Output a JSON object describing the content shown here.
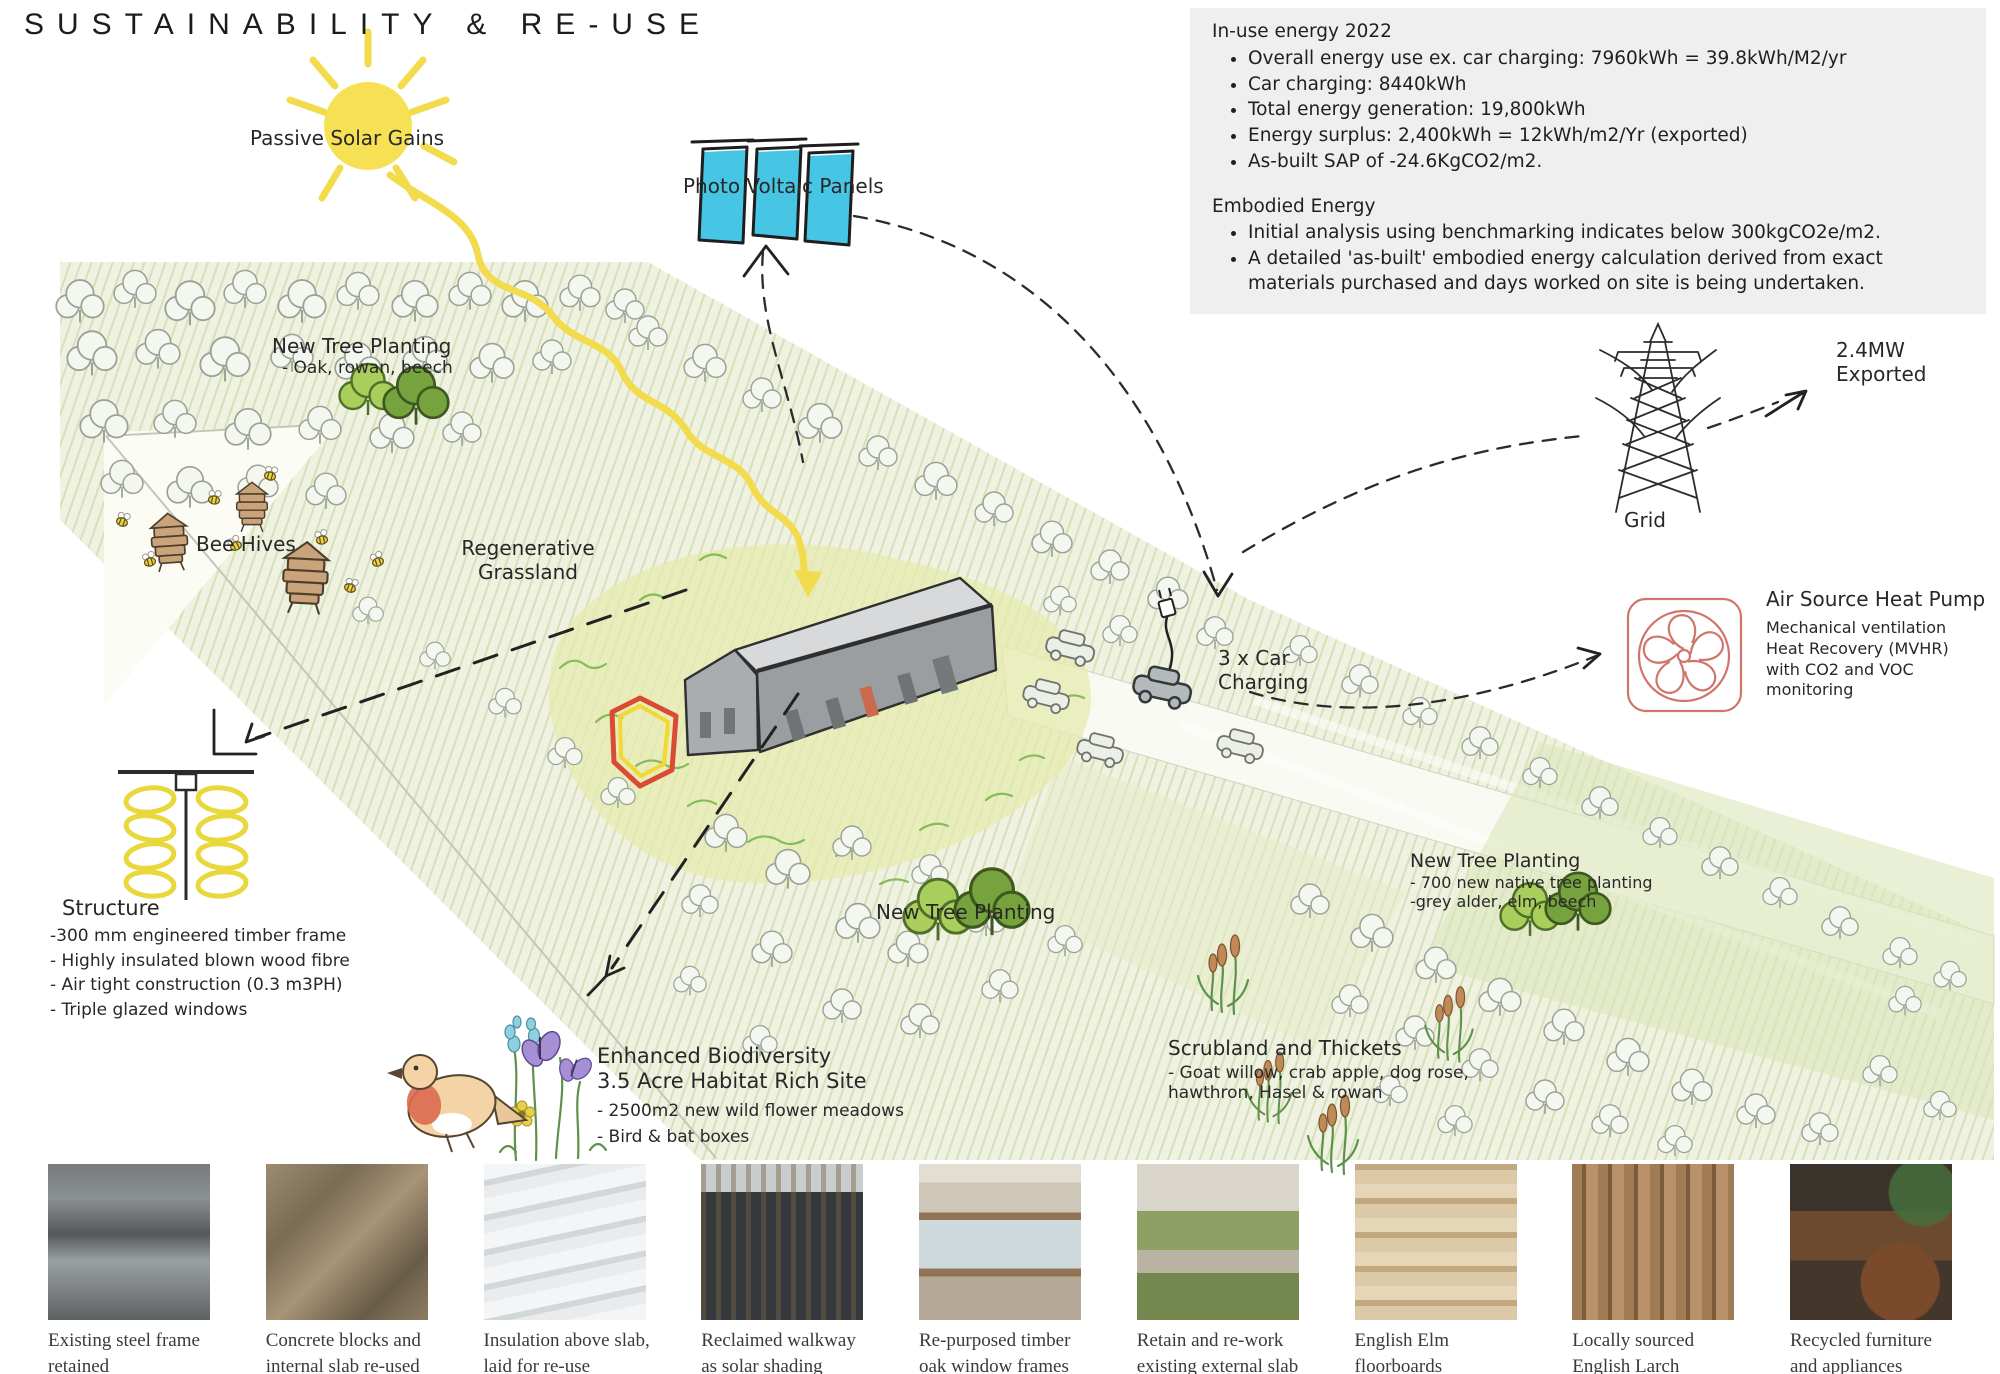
{
  "title": "SUSTAINABILITY & RE-USE",
  "energy_box": {
    "in_use": {
      "heading": "In-use energy 2022",
      "bullets": [
        "Overall energy use ex. car charging: 7960kWh = 39.8kWh/M2/yr",
        "Car charging: 8440kWh",
        "Total energy generation: 19,800kWh",
        "Energy surplus: 2,400kWh = 12kWh/m2/Yr (exported)",
        "As-built SAP of -24.6KgCO2/m2."
      ]
    },
    "embodied": {
      "heading": "Embodied Energy",
      "bullets": [
        "Initial analysis using benchmarking indicates below 300kgCO2e/m2.",
        "A detailed 'as-built' embodied energy calculation derived from exact materials purchased and days worked on site is being undertaken."
      ]
    }
  },
  "diagram": {
    "passive_solar": "Passive Solar Gains",
    "pv_panels": "Photo Voltaic Panels",
    "tree_planting_nw": {
      "title": "New Tree Planting",
      "sub": "- Oak, rowan, beech"
    },
    "bee_hives": "Bee Hives",
    "grassland": {
      "line1": "Regenerative",
      "line2": "Grassland"
    },
    "car_charging": {
      "line1": "3 x Car",
      "line2": "Charging"
    },
    "grid": "Grid",
    "exported": {
      "line1": "2.4MW",
      "line2": "Exported"
    },
    "ashp": {
      "title": "Air Source Heat Pump",
      "desc": "Mechanical ventilation Heat Recovery (MVHR) with CO2 and VOC monitoring"
    },
    "structure": {
      "title": "Structure",
      "lines": [
        "-300 mm engineered timber frame",
        "- Highly insulated blown wood fibre",
        "- Air tight construction (0.3 m3PH)",
        "- Triple glazed windows"
      ]
    },
    "biodiversity": {
      "line1": "Enhanced Biodiversity",
      "line2": "3.5 Acre Habitat Rich Site",
      "bullets": [
        "- 2500m2 new wild flower meadows",
        "- Bird & bat boxes"
      ]
    },
    "tree_planting_mid": "New Tree Planting",
    "scrubland": {
      "title": "Scrubland and Thickets",
      "line2": "- Goat willow, crab apple, dog rose,",
      "line3": "hawthron, Hasel & rowan"
    },
    "tree_planting_east": {
      "title": "New Tree Planting",
      "line2": "- 700 new native tree planting",
      "line3": "-grey alder, elm, beech"
    }
  },
  "photos": [
    {
      "caption": "Existing steel frame retained"
    },
    {
      "caption": "Concrete blocks and internal slab re-used"
    },
    {
      "caption": "Insulation above slab, laid for re-use"
    },
    {
      "caption": "Reclaimed walkway as solar shading"
    },
    {
      "caption": "Re-purposed timber oak window frames"
    },
    {
      "caption": "Retain and re-work existing external slab"
    },
    {
      "caption": "English Elm floorboards"
    },
    {
      "caption": "Locally sourced English Larch cladding"
    },
    {
      "caption": "Recycled furniture and appliances throughout"
    }
  ],
  "colors": {
    "sun": "#f6e054",
    "pv_panel": "#47c5e5",
    "tree_light": "#a9ce5b",
    "tree_dark": "#77a33f",
    "heat_pump_red": "#d0756a",
    "insulation_yellow": "#e9d83b",
    "panel_background": "#efefef",
    "site_outline_red": "#d94b33"
  }
}
